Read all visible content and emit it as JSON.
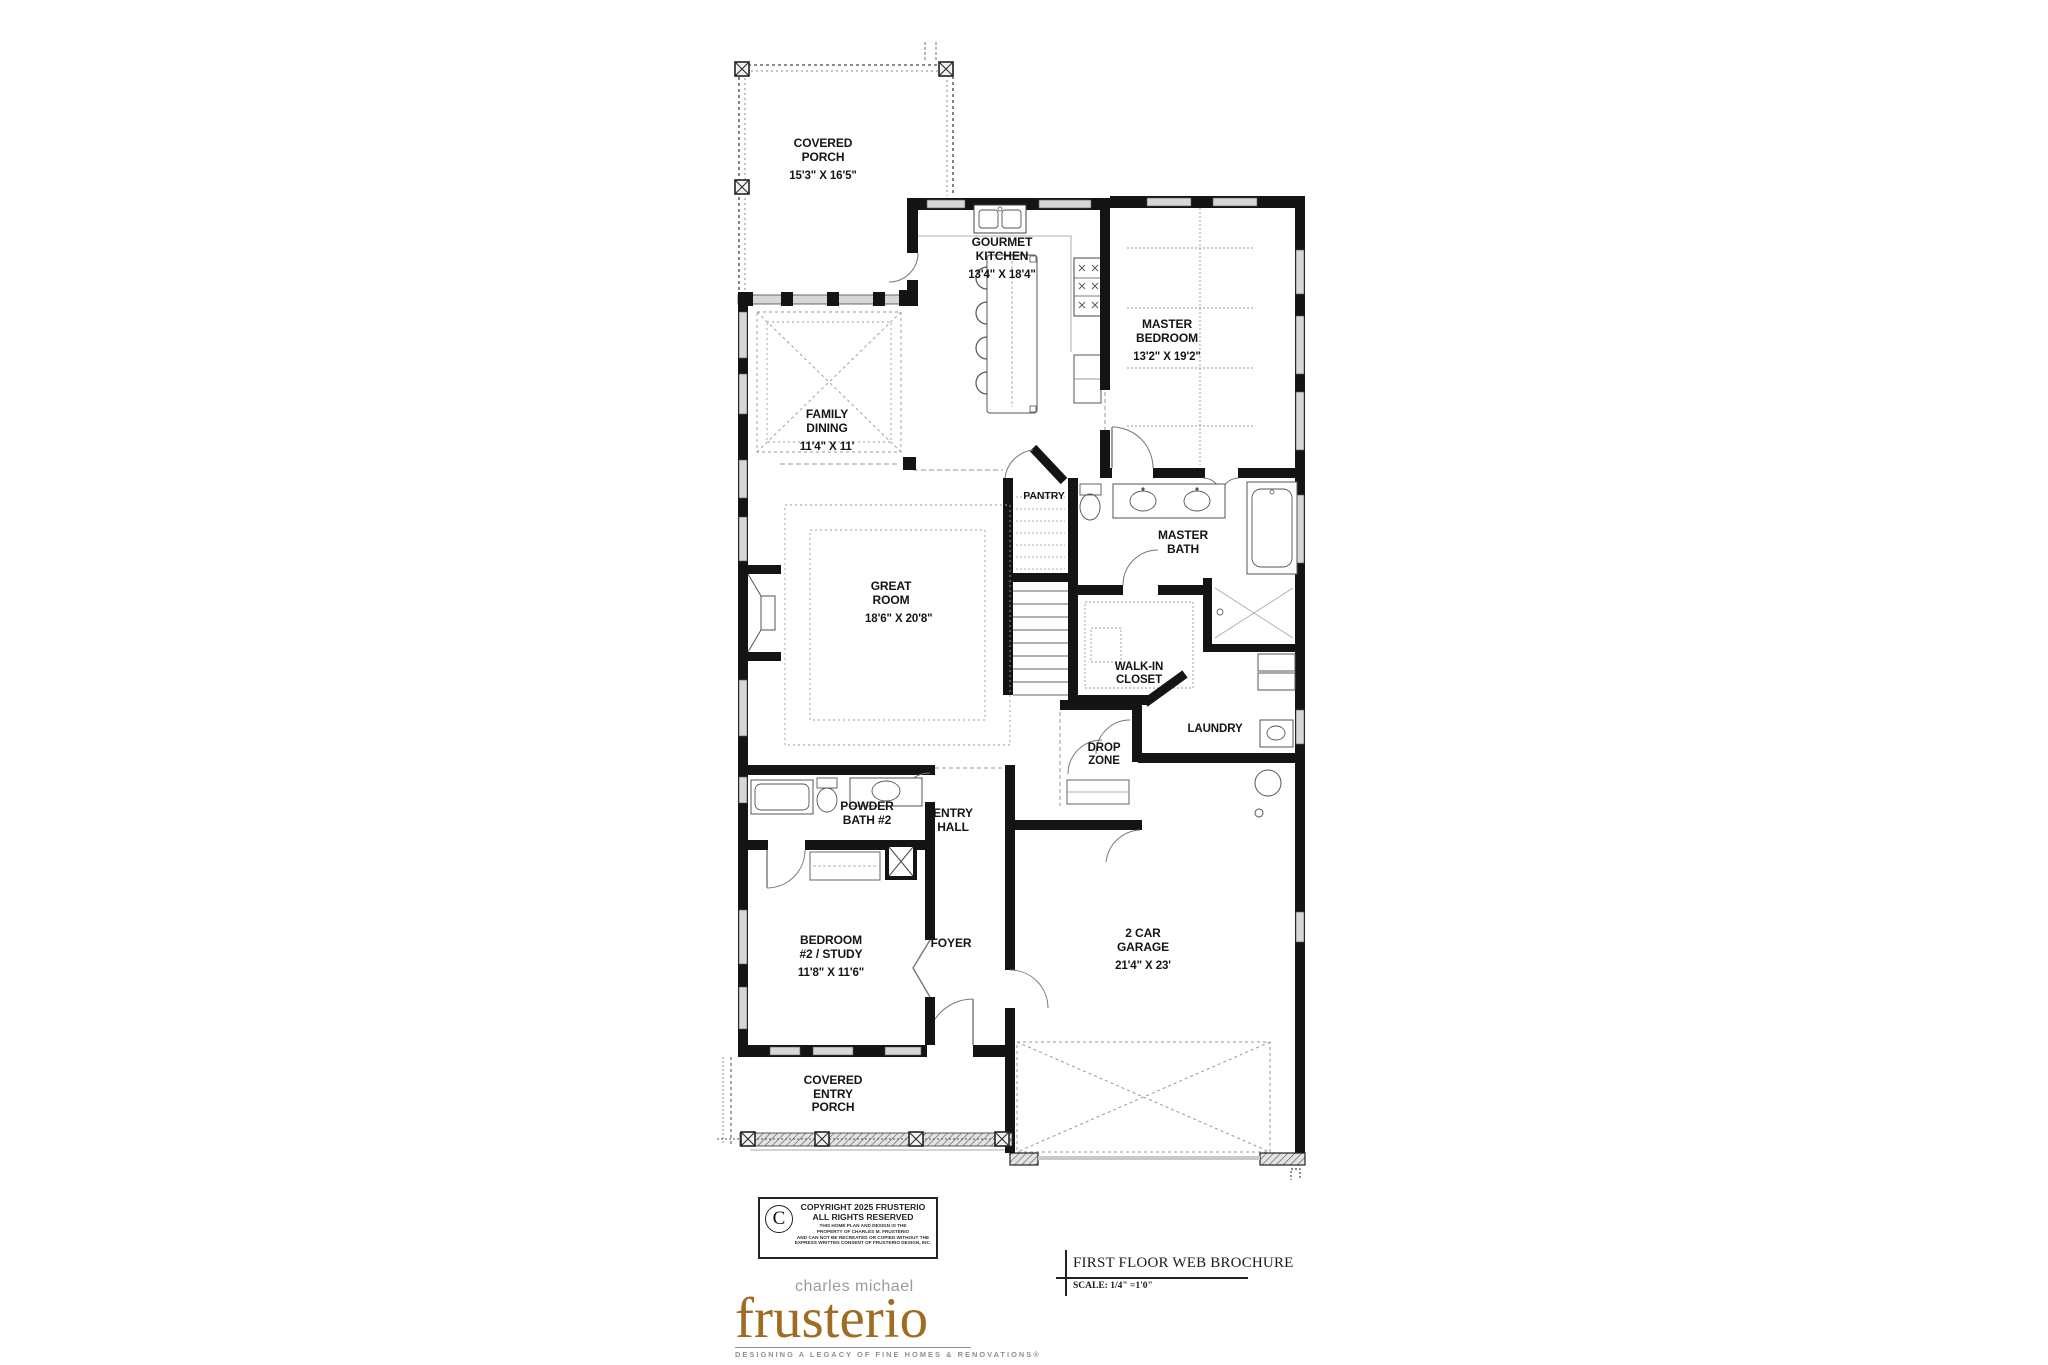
{
  "floor_plan": {
    "rooms": [
      {
        "name": "COVERED PORCH",
        "dims": "15'3\" X 16'5\""
      },
      {
        "name": "GOURMET KITCHEN",
        "dims": "13'4\" X 18'4\""
      },
      {
        "name": "MASTER BEDROOM",
        "dims": "13'2\" X 19'2\""
      },
      {
        "name": "FAMILY DINING",
        "dims": "11'4\" X 11'"
      },
      {
        "name": "GREAT ROOM",
        "dims": "18'6\" X 20'8\""
      },
      {
        "name": "PANTRY",
        "dims": ""
      },
      {
        "name": "MASTER BATH",
        "dims": ""
      },
      {
        "name": "WALK-IN CLOSET",
        "dims": ""
      },
      {
        "name": "LAUNDRY",
        "dims": ""
      },
      {
        "name": "DROP ZONE",
        "dims": ""
      },
      {
        "name": "ENTRY HALL",
        "dims": ""
      },
      {
        "name": "POWDER BATH #2",
        "dims": ""
      },
      {
        "name": "BEDROOM #2 / STUDY",
        "dims": "11'8\" X 11'6\""
      },
      {
        "name": "FOYER",
        "dims": ""
      },
      {
        "name": "2 CAR GARAGE",
        "dims": "21'4\" X 23'"
      },
      {
        "name": "COVERED ENTRY PORCH",
        "dims": ""
      }
    ]
  },
  "copyright": {
    "symbol": "C",
    "line1": "COPYRIGHT 2025 FRUSTERIO",
    "line2": "ALL RIGHTS RESERVED",
    "fine_print": [
      "THIS HOME PLAN AND DESIGN IS THE",
      "PROPERTY OF CHARLES M. FRUSTERIO",
      "AND CAN NOT BE RECREATED OR COPIED WITHOUT THE",
      "EXPRESS WRITTEN CONSENT OF FRUSTERIO DESIGN, INC."
    ]
  },
  "logo": {
    "pre": "charles michael",
    "name": "frusterio",
    "tagline": "DESIGNING A LEGACY OF FINE HOMES & RENOVATIONS®",
    "color": "#a06c24"
  },
  "title_block": {
    "title": "FIRST FLOOR WEB BROCHURE",
    "scale": "SCALE:  1/4\" =1'0\""
  }
}
